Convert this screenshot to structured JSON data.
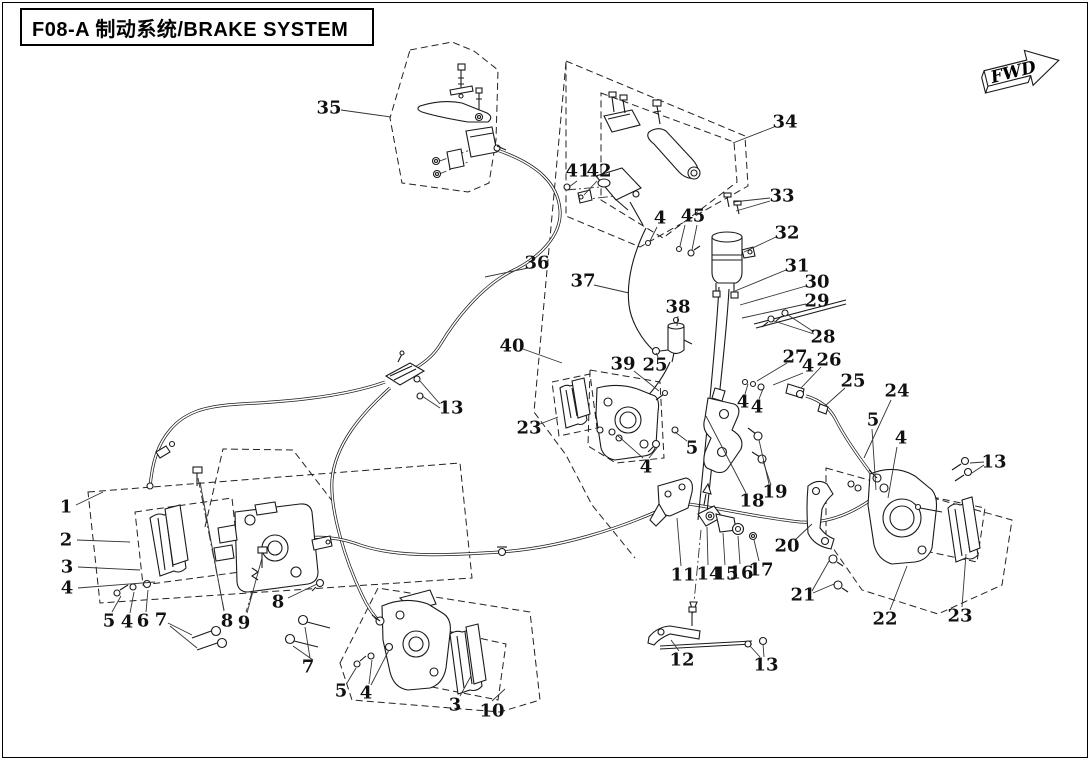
{
  "header": {
    "title": "F08-A 制动系统/BRAKE SYSTEM"
  },
  "direction_arrow": {
    "label": "FWD"
  },
  "callouts": [
    {
      "n": "35",
      "x": 329,
      "y": 108,
      "leaders": [
        [
          341,
          110,
          391,
          117
        ]
      ]
    },
    {
      "n": "36",
      "x": 537,
      "y": 263,
      "leaders": [
        [
          528,
          268,
          485,
          277
        ]
      ]
    },
    {
      "n": "37",
      "x": 583,
      "y": 281,
      "leaders": [
        [
          594,
          285,
          629,
          293
        ]
      ]
    },
    {
      "n": "40",
      "x": 512,
      "y": 346,
      "leaders": [
        [
          523,
          349,
          562,
          363
        ]
      ]
    },
    {
      "n": "38",
      "x": 678,
      "y": 307,
      "leaders": [
        [
          678,
          316,
          677,
          326
        ]
      ]
    },
    {
      "n": "39",
      "x": 623,
      "y": 364,
      "leaders": [
        [
          634,
          371,
          659,
          391
        ]
      ]
    },
    {
      "n": "25",
      "x": 655,
      "y": 365,
      "leaders": [
        [
          658,
          357,
          656,
          353
        ]
      ]
    },
    {
      "n": "41",
      "x": 578,
      "y": 171,
      "leaders": [
        [
          577,
          181,
          569,
          187
        ]
      ]
    },
    {
      "n": "42",
      "x": 599,
      "y": 171,
      "leaders": [
        [
          597,
          181,
          584,
          195
        ]
      ]
    },
    {
      "n": "34",
      "x": 785,
      "y": 122,
      "leaders": [
        [
          774,
          127,
          733,
          143
        ]
      ]
    },
    {
      "n": "33",
      "x": 782,
      "y": 196,
      "leaders": [
        [
          770,
          198,
          733,
          202
        ],
        [
          770,
          201,
          736,
          211
        ]
      ]
    },
    {
      "n": "32",
      "x": 787,
      "y": 233,
      "leaders": [
        [
          776,
          237,
          744,
          252
        ]
      ]
    },
    {
      "n": "31",
      "x": 797,
      "y": 266,
      "leaders": [
        [
          786,
          270,
          735,
          291
        ]
      ]
    },
    {
      "n": "30",
      "x": 817,
      "y": 282,
      "leaders": [
        [
          806,
          286,
          740,
          305
        ]
      ]
    },
    {
      "n": "29",
      "x": 817,
      "y": 301,
      "leaders": [
        [
          806,
          304,
          742,
          318
        ]
      ]
    },
    {
      "n": "28",
      "x": 823,
      "y": 337,
      "leaders": [
        [
          814,
          332,
          788,
          315
        ],
        [
          814,
          334,
          774,
          321
        ]
      ]
    },
    {
      "n": "27",
      "x": 795,
      "y": 357,
      "leaders": [
        [
          787,
          363,
          757,
          381
        ]
      ]
    },
    {
      "n": "4",
      "x": 808,
      "y": 366,
      "leaders": [
        [
          803,
          373,
          773,
          385
        ]
      ]
    },
    {
      "n": "26",
      "x": 829,
      "y": 360,
      "leaders": [
        [
          821,
          367,
          801,
          388
        ]
      ]
    },
    {
      "n": "25",
      "x": 853,
      "y": 381,
      "leaders": [
        [
          845,
          388,
          825,
          406
        ]
      ]
    },
    {
      "n": "24",
      "x": 897,
      "y": 391,
      "leaders": [
        [
          891,
          400,
          864,
          458
        ]
      ]
    },
    {
      "n": "5",
      "x": 873,
      "y": 420,
      "leaders": [
        [
          872,
          429,
          876,
          490
        ]
      ]
    },
    {
      "n": "4",
      "x": 901,
      "y": 438,
      "leaders": [
        [
          897,
          447,
          888,
          498
        ]
      ]
    },
    {
      "n": "13",
      "x": 994,
      "y": 462,
      "leaders": [
        [
          984,
          462,
          970,
          463
        ],
        [
          984,
          465,
          972,
          473
        ]
      ]
    },
    {
      "n": "4",
      "x": 743,
      "y": 402,
      "leaders": [
        [
          745,
          394,
          748,
          384
        ]
      ]
    },
    {
      "n": "4",
      "x": 757,
      "y": 407,
      "leaders": [
        [
          759,
          399,
          763,
          389
        ]
      ]
    },
    {
      "n": "4",
      "x": 660,
      "y": 218,
      "leaders": [
        [
          657,
          227,
          650,
          241
        ]
      ]
    },
    {
      "n": "4",
      "x": 687,
      "y": 216,
      "leaders": [
        [
          685,
          225,
          680,
          246
        ]
      ]
    },
    {
      "n": "5",
      "x": 699,
      "y": 216,
      "leaders": [
        [
          697,
          225,
          692,
          250
        ]
      ]
    },
    {
      "n": "23",
      "x": 529,
      "y": 428,
      "leaders": [
        [
          540,
          424,
          558,
          417
        ]
      ]
    },
    {
      "n": "4",
      "x": 646,
      "y": 467,
      "leaders": [
        [
          643,
          458,
          617,
          435
        ],
        [
          649,
          458,
          657,
          448
        ]
      ]
    },
    {
      "n": "5",
      "x": 692,
      "y": 448,
      "leaders": [
        [
          687,
          441,
          675,
          432
        ]
      ]
    },
    {
      "n": "18",
      "x": 752,
      "y": 501,
      "leaders": [
        [
          746,
          493,
          706,
          416
        ]
      ]
    },
    {
      "n": "19",
      "x": 775,
      "y": 492,
      "leaders": [
        [
          769,
          484,
          759,
          440
        ],
        [
          771,
          485,
          763,
          461
        ]
      ]
    },
    {
      "n": "11",
      "x": 683,
      "y": 575,
      "leaders": [
        [
          681,
          566,
          677,
          518
        ]
      ]
    },
    {
      "n": "14",
      "x": 709,
      "y": 574,
      "leaders": [
        [
          708,
          565,
          707,
          527
        ]
      ]
    },
    {
      "n": "15",
      "x": 726,
      "y": 574,
      "leaders": [
        [
          725,
          565,
          723,
          533
        ]
      ]
    },
    {
      "n": "16",
      "x": 741,
      "y": 573,
      "leaders": [
        [
          740,
          564,
          738,
          536
        ]
      ]
    },
    {
      "n": "17",
      "x": 761,
      "y": 570,
      "leaders": [
        [
          759,
          561,
          754,
          540
        ]
      ]
    },
    {
      "n": "20",
      "x": 787,
      "y": 546,
      "leaders": [
        [
          795,
          540,
          812,
          524
        ]
      ]
    },
    {
      "n": "21",
      "x": 803,
      "y": 595,
      "leaders": [
        [
          812,
          591,
          829,
          561
        ],
        [
          813,
          593,
          834,
          584
        ]
      ]
    },
    {
      "n": "12",
      "x": 682,
      "y": 660,
      "leaders": [
        [
          679,
          651,
          671,
          640
        ]
      ]
    },
    {
      "n": "13",
      "x": 766,
      "y": 665,
      "leaders": [
        [
          760,
          657,
          750,
          646
        ],
        [
          764,
          657,
          763,
          644
        ]
      ]
    },
    {
      "n": "22",
      "x": 885,
      "y": 619,
      "leaders": [
        [
          890,
          610,
          907,
          566
        ]
      ]
    },
    {
      "n": "23",
      "x": 960,
      "y": 616,
      "leaders": [
        [
          962,
          607,
          966,
          554
        ]
      ]
    },
    {
      "n": "13",
      "x": 451,
      "y": 408,
      "leaders": [
        [
          440,
          404,
          420,
          381
        ],
        [
          440,
          408,
          422,
          396
        ]
      ]
    },
    {
      "n": "1",
      "x": 66,
      "y": 507,
      "leaders": [
        [
          76,
          505,
          103,
          492
        ]
      ]
    },
    {
      "n": "2",
      "x": 66,
      "y": 540,
      "leaders": [
        [
          77,
          540,
          130,
          542
        ]
      ]
    },
    {
      "n": "3",
      "x": 67,
      "y": 567,
      "leaders": [
        [
          78,
          567,
          140,
          570
        ]
      ]
    },
    {
      "n": "4",
      "x": 67,
      "y": 588,
      "leaders": [
        [
          78,
          588,
          155,
          582
        ]
      ]
    },
    {
      "n": "5",
      "x": 109,
      "y": 621,
      "leaders": [
        [
          112,
          612,
          121,
          596
        ]
      ]
    },
    {
      "n": "4",
      "x": 127,
      "y": 622,
      "leaders": [
        [
          130,
          613,
          134,
          592
        ]
      ]
    },
    {
      "n": "6",
      "x": 143,
      "y": 621,
      "leaders": [
        [
          146,
          612,
          148,
          590
        ]
      ]
    },
    {
      "n": "7",
      "x": 161,
      "y": 620,
      "leaders": [
        [
          168,
          623,
          192,
          635
        ],
        [
          170,
          626,
          197,
          648
        ]
      ]
    },
    {
      "n": "8",
      "x": 227,
      "y": 621,
      "leaders": [
        [
          224,
          611,
          200,
          482
        ]
      ]
    },
    {
      "n": "9",
      "x": 244,
      "y": 623,
      "leaders": [
        [
          247,
          613,
          262,
          558
        ]
      ]
    },
    {
      "n": "8",
      "x": 278,
      "y": 602,
      "leaders": [
        [
          288,
          598,
          317,
          584
        ]
      ]
    },
    {
      "n": "7",
      "x": 308,
      "y": 667,
      "leaders": [
        [
          310,
          658,
          305,
          627
        ],
        [
          313,
          660,
          293,
          646
        ]
      ]
    },
    {
      "n": "5",
      "x": 341,
      "y": 691,
      "leaders": [
        [
          347,
          683,
          356,
          668
        ]
      ]
    },
    {
      "n": "4",
      "x": 366,
      "y": 693,
      "leaders": [
        [
          369,
          684,
          372,
          660
        ],
        [
          371,
          685,
          389,
          650
        ]
      ]
    },
    {
      "n": "3",
      "x": 455,
      "y": 705,
      "leaders": [
        [
          460,
          696,
          471,
          676
        ]
      ]
    },
    {
      "n": "10",
      "x": 492,
      "y": 711,
      "leaders": [
        [
          492,
          701,
          505,
          689
        ]
      ]
    }
  ]
}
